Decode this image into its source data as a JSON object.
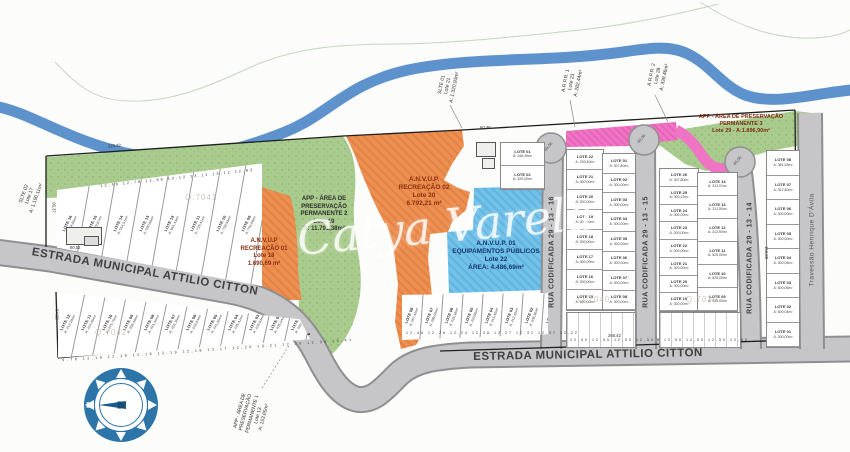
{
  "colors": {
    "river": "#5d92cc",
    "road": "#c6c6c8",
    "road_edge": "#8f8f91",
    "green": "#a9cb8d",
    "orange": "#eb8f53",
    "blue_zone": "#72c1e9",
    "pink": "#ef74c4",
    "compass": "#2d74a9",
    "boundary": "#1f1f1f"
  },
  "watermark": {
    "script": "Catya Varela"
  },
  "quads": {
    "q1": "Q.7041",
    "q2": "Q.7042",
    "q3": "Q.7040",
    "q4": "Q.7039"
  },
  "compass": {
    "north": "N"
  },
  "streets": {
    "estrada_left": "ESTRADA MUNICIPAL ATTILIO CITTON",
    "estrada_bottom": "ESTRADA MUNICIPAL ATTILIO CITTON",
    "rua_16": "RUA CODIFICADA 29 - 13 - 16",
    "rua_15": "RUA CODIFICADA 29 - 13 - 15",
    "rua_14": "RUA CODIFICADA 29 - 13 - 14",
    "travessao": "Travessão Henrique D'Ávila"
  },
  "zones": {
    "app2": "APP - ÁREA DE\nPRESERVAÇÃO\nPERMANENTE 2\nLote 19\nA: 11.791,38m²",
    "recreacao1": "A.N.V.U.P\nRECREAÇÃO 01\nLote 18\n1.690,69 m²",
    "recreacao2": "A.N.V.U.P.\nRECREAÇÃO 02\nLote 20\n6.792,21 m²",
    "equipamentos": "A.N.V.U.P. 01\nEQUIPAMENTOS PÚBLICOS\nLote 22\nÁREA: 4.486,69m²",
    "app3": "APP - ÁREA DE PRESERVAÇÃO\nPERMANENTE 3\nLote 29 - A:1.896,90m²",
    "app1": "APP - ÁREA DE\nPRESERVAÇÃO\nPERMANENTE 1\nLote 13\nA: 153,65m²",
    "slte02": "SLTE 02\nLote 17\nA: 1.190,11m²",
    "slte01": "SLTE 01\nLote 21\nA: 1.320,93m²",
    "arpr1": "A.R.P.R. 1\nLote 23\nA: 282,44m²",
    "arpr2": "A.R.P.R. 2\nLote 28\nA: 339,46m²"
  },
  "dims": {
    "top": "224,32",
    "top2": "60,40",
    "left": "95,37",
    "left2": "54,32",
    "bldg": "80,52",
    "bottom": "268,42",
    "right": "153,88",
    "cul": "48,06"
  },
  "lots": {
    "block_a": [
      {
        "n": "LOTE 16",
        "a": "A: 464,65m²"
      },
      {
        "n": "LOTE 15",
        "a": "A: 479,87m²"
      },
      {
        "n": "LOTE 14",
        "a": "A: 554,51m²"
      },
      {
        "n": "LOTE 13",
        "a": "A: 590,65m²"
      },
      {
        "n": "LOTE 12",
        "a": "A: 661,43m²"
      },
      {
        "n": "LOTE 11",
        "a": "A: 728,42m²"
      },
      {
        "n": "LOTE 10",
        "a": "A: 758,93m²"
      },
      {
        "n": "LOTE 09",
        "a": "A: 794,88m²"
      }
    ],
    "block_a_widths": "12,49   12,78   12,89   13,12   13,11   13,12   12,83",
    "block_b": [
      {
        "n": "LOTE 12",
        "a": "A: 412,28m²"
      },
      {
        "n": "LOTE 11",
        "a": "A: 424,85m²"
      },
      {
        "n": "LOTE 10",
        "a": "A: 375,75m²"
      },
      {
        "n": "LOTE 09",
        "a": "A: 356,48m²"
      },
      {
        "n": "LOTE 08",
        "a": "A: 461,40m²"
      },
      {
        "n": "LOTE 07",
        "a": "A: 455,35m²"
      },
      {
        "n": "LOTE 06",
        "a": "A: 448,64m²"
      },
      {
        "n": "LOTE 05",
        "a": "A: 441,50m²"
      },
      {
        "n": "LOTE 04",
        "a": "A: 435,42m²"
      },
      {
        "n": "LOTE 03",
        "a": "A: 428,53m²"
      },
      {
        "n": "LOTE 02",
        "a": "A: 405,04m²"
      },
      {
        "n": "LOTE 01",
        "a": "A: 482,82m²"
      }
    ],
    "block_b_widths": "9,78  12,19  12,19  12,19  12,19  12,18  12,17  12,20  13,21  12,20  12,34  13,41",
    "block_c": [
      {
        "n": "LOTE 08",
        "a": "A: 457,40m²"
      },
      {
        "n": "LOTE 07",
        "a": "A: 398,00m²"
      },
      {
        "n": "LOTE 06",
        "a": "A: 428,18m²"
      },
      {
        "n": "LOTE 05",
        "a": "A: 420,95m²"
      },
      {
        "n": "LOTE 04",
        "a": "A: 415,45m²"
      },
      {
        "n": "LOTE 03",
        "a": "A: 412,45m²"
      },
      {
        "n": "LOTE 02",
        "a": "A: 408,36m²"
      },
      {
        "n": "LOTE 01",
        "a": "A: 267,34m²"
      }
    ],
    "block_c_widths": "12,48  12,26  12,24  12,38  12,27  12,32  12,37  12,22",
    "col_a": [
      {
        "n": "LOTE 01",
        "a": "A: 246,49m²"
      },
      {
        "n": "LOTE 02",
        "a": "A: 325,00m²"
      }
    ],
    "col_b": [
      {
        "n": "LOTE 22",
        "a": "A: 239,40m²"
      },
      {
        "n": "LOTE 21",
        "a": "A: 300,00m²"
      },
      {
        "n": "LOTE 20",
        "a": "A: 300,00m²"
      },
      {
        "n": "LOTE 19",
        "a": "A: 300,00m²"
      },
      {
        "n": "LOTE 18",
        "a": "A: 300,00m²"
      },
      {
        "n": "LOTE 17",
        "a": "A: 300,00m²"
      },
      {
        "n": "LOTE 16",
        "a": "A: 300,00m²"
      },
      {
        "n": "LOTE 15",
        "a": "A: 300,00m²"
      }
    ],
    "col_b2": [
      {
        "n": "LOTE 01",
        "a": "A: 307,80m²"
      },
      {
        "n": "LOTE 02",
        "a": "A: 300,00m²"
      },
      {
        "n": "LOTE 03",
        "a": "A: 300,00m²"
      },
      {
        "n": "LOTE 04",
        "a": "A: 300,00m²"
      },
      {
        "n": "LOTE 05",
        "a": "A: 300,00m²"
      },
      {
        "n": "LOTE 06",
        "a": "A: 300,00m²"
      },
      {
        "n": "LOTE 07",
        "a": "A: 300,00m²"
      },
      {
        "n": "LOTE 08",
        "a": "A: 300,00m²"
      }
    ],
    "col_d": [
      {
        "n": "LOTE 26",
        "a": "A: 307,80m²"
      },
      {
        "n": "LOTE 25",
        "a": "A: 300,12m²"
      },
      {
        "n": "LOTE 24",
        "a": "A: 300,00m²"
      },
      {
        "n": "LOTE 23",
        "a": "A: 300,00m²"
      },
      {
        "n": "LOTE 22",
        "a": "A: 300,00m²"
      },
      {
        "n": "LOTE 21",
        "a": "A: 300,00m²"
      },
      {
        "n": "LOTE 20",
        "a": "A: 300,00m²"
      },
      {
        "n": "LOTE 19",
        "a": "A: 300,00m²"
      }
    ],
    "col_e": [
      {
        "n": "LOTE 14",
        "a": "A: 312,01m²"
      },
      {
        "n": "LOTE 13",
        "a": "A: 312,50m²"
      },
      {
        "n": "LOTE 12",
        "a": "A: 312,50m²"
      },
      {
        "n": "LOTE 11",
        "a": "A: 525,00m²"
      },
      {
        "n": "LOTE 10",
        "a": "A: 525,00m²"
      },
      {
        "n": "LOTE 09",
        "a": "A: 525,00m²"
      }
    ],
    "col_f": [
      {
        "n": "LOTE 08",
        "a": "A: 381,93m²"
      },
      {
        "n": "LOTE 07",
        "a": "A: 312,50m²"
      },
      {
        "n": "LOTE 06",
        "a": "A: 300,00m²"
      },
      {
        "n": "LOTE 05",
        "a": "A: 300,00m²"
      },
      {
        "n": "LOTE 04",
        "a": "A: 300,05m²"
      },
      {
        "n": "LOTE 03",
        "a": "A: 600,06m²"
      },
      {
        "n": "LOTE 02",
        "a": "A: 600,04m²"
      },
      {
        "n": "LOTE 01",
        "a": "A: 300,00m²"
      }
    ],
    "bs_widths": "12,50  12,50  12,50  12,50"
  }
}
